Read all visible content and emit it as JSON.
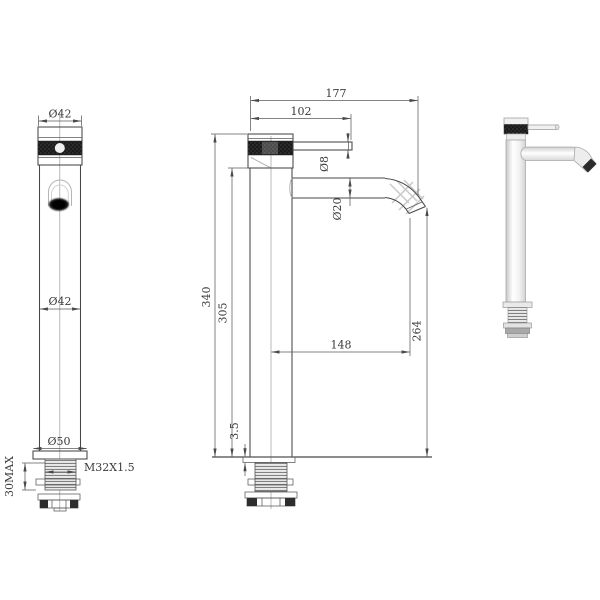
{
  "page": {
    "background": "#ffffff",
    "ink": "#474747",
    "dark_fill": "#1b1b1b"
  },
  "front_view": {
    "top_diameter": "Ø42",
    "body_diameter": "Ø42",
    "base_diameter": "Ø50",
    "thread_spec": "M32X1.5",
    "deck_max": "30MAX"
  },
  "side_view": {
    "total_projection": "177",
    "lever_projection": "102",
    "lever_diameter": "Ø8",
    "spout_diameter": "Ø20",
    "total_height": "340",
    "body_height": "305",
    "spout_reach": "148",
    "outlet_height": "264",
    "flange_thickness": "3.5"
  }
}
